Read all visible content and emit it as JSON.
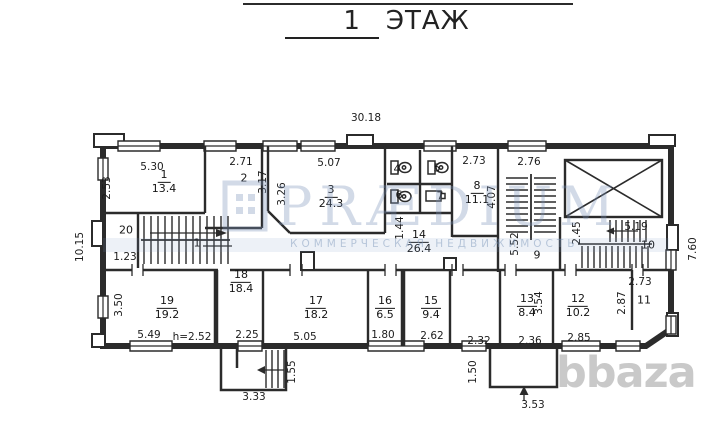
{
  "title": {
    "number": "1",
    "word": "ЭТАЖ"
  },
  "watermark_praedium": {
    "name": "PRÆDIUM",
    "tagline": "КОММЕРЧЕСКАЯ НЕДВИЖИМОСТЬ"
  },
  "watermark_bbaza": {
    "text": "bbaza"
  },
  "colors": {
    "line": "#2b2b2b",
    "label": "#1c1c1c",
    "watermark_blue": "#7a94b8",
    "watermark_gray": "#c9c9c9"
  },
  "rooms": [
    {
      "id": "room-1",
      "num": "1",
      "area": "13.4",
      "x": 164,
      "y": 182
    },
    {
      "id": "room-2",
      "num": "2",
      "x": 244,
      "y": 179
    },
    {
      "id": "room-3",
      "num": "3",
      "area": "24.3",
      "x": 331,
      "y": 197
    },
    {
      "id": "room-4",
      "num": "4",
      "x": 397,
      "y": 170
    },
    {
      "id": "room-5",
      "num": "5",
      "x": 437,
      "y": 169
    },
    {
      "id": "room-6",
      "num": "6",
      "x": 399,
      "y": 196
    },
    {
      "id": "room-7",
      "num": "7",
      "x": 440,
      "y": 197
    },
    {
      "id": "room-8",
      "num": "8",
      "area": "11.1",
      "x": 477,
      "y": 193
    },
    {
      "id": "room-9",
      "num": "9",
      "x": 537,
      "y": 256
    },
    {
      "id": "room-10",
      "num": "10",
      "x": 648,
      "y": 246
    },
    {
      "id": "room-11",
      "num": "11",
      "x": 644,
      "y": 301
    },
    {
      "id": "room-12",
      "num": "12",
      "area": "10.2",
      "x": 578,
      "y": 306
    },
    {
      "id": "room-13",
      "num": "13",
      "area": "8.4",
      "x": 527,
      "y": 306
    },
    {
      "id": "room-14",
      "num": "14",
      "area": "26.4",
      "x": 419,
      "y": 242
    },
    {
      "id": "room-15",
      "num": "15",
      "area": "9.4",
      "x": 431,
      "y": 308
    },
    {
      "id": "room-16",
      "num": "16",
      "area": "6.5",
      "x": 385,
      "y": 308
    },
    {
      "id": "room-17",
      "num": "17",
      "area": "18.2",
      "x": 316,
      "y": 308
    },
    {
      "id": "room-18",
      "num": "18",
      "area": "18.4",
      "x": 241,
      "y": 282
    },
    {
      "id": "room-19",
      "num": "19",
      "area": "19.2",
      "x": 167,
      "y": 308
    },
    {
      "id": "room-20",
      "num": "20",
      "x": 126,
      "y": 231
    },
    {
      "id": "landing-1",
      "num": "1",
      "x": 197,
      "y": 244
    }
  ],
  "dims": [
    {
      "id": "building-width",
      "text": "30.18",
      "x": 366,
      "y": 118
    },
    {
      "id": "building-height-left",
      "text": "10.15",
      "x": 80,
      "y": 247,
      "rot": true
    },
    {
      "id": "building-height-right",
      "text": "7.60",
      "x": 693,
      "y": 249,
      "rot": true
    },
    {
      "id": "dim-5-30",
      "text": "5.30",
      "x": 152,
      "y": 167
    },
    {
      "id": "dim-2-53",
      "text": "2.53",
      "x": 107,
      "y": 188,
      "rot": true
    },
    {
      "id": "dim-2-71",
      "text": "2.71",
      "x": 241,
      "y": 162
    },
    {
      "id": "dim-3-17",
      "text": "3.17",
      "x": 263,
      "y": 182,
      "rot": true
    },
    {
      "id": "dim-3-26",
      "text": "3.26",
      "x": 282,
      "y": 194,
      "rot": true
    },
    {
      "id": "dim-5-07",
      "text": "5.07",
      "x": 329,
      "y": 163
    },
    {
      "id": "dim-2-73-a",
      "text": "2.73",
      "x": 474,
      "y": 161
    },
    {
      "id": "dim-4-07",
      "text": "4.07",
      "x": 492,
      "y": 197,
      "rot": true
    },
    {
      "id": "dim-2-76",
      "text": "2.76",
      "x": 529,
      "y": 162
    },
    {
      "id": "dim-2-45",
      "text": "2.45",
      "x": 577,
      "y": 233,
      "rot": true
    },
    {
      "id": "dim-5-19",
      "text": "5.19",
      "x": 636,
      "y": 227
    },
    {
      "id": "dim-5-52",
      "text": "5.52",
      "x": 515,
      "y": 244,
      "rot": true
    },
    {
      "id": "dim-1-44",
      "text": "1.44",
      "x": 400,
      "y": 228,
      "rot": true
    },
    {
      "id": "dim-1-23",
      "text": "1.23",
      "x": 125,
      "y": 257
    },
    {
      "id": "dim-3-50",
      "text": "3.50",
      "x": 119,
      "y": 305,
      "rot": true
    },
    {
      "id": "dim-5-49",
      "text": "5.49",
      "x": 149,
      "y": 335
    },
    {
      "id": "dim-h-2-52",
      "text": "h=2.52",
      "x": 192,
      "y": 337
    },
    {
      "id": "dim-2-25",
      "text": "2.25",
      "x": 247,
      "y": 335
    },
    {
      "id": "dim-5-05",
      "text": "5.05",
      "x": 305,
      "y": 337
    },
    {
      "id": "dim-1-80",
      "text": "1.80",
      "x": 383,
      "y": 335
    },
    {
      "id": "dim-2-62",
      "text": "2.62",
      "x": 432,
      "y": 336
    },
    {
      "id": "dim-2-32",
      "text": "2.32",
      "x": 479,
      "y": 341
    },
    {
      "id": "dim-2-36",
      "text": "2.36",
      "x": 530,
      "y": 341
    },
    {
      "id": "dim-2-85",
      "text": "2.85",
      "x": 579,
      "y": 338
    },
    {
      "id": "dim-3-54",
      "text": "3.54",
      "x": 539,
      "y": 303,
      "rot": true
    },
    {
      "id": "dim-2-73-b",
      "text": "2.73",
      "x": 640,
      "y": 282
    },
    {
      "id": "dim-2-87",
      "text": "2.87",
      "x": 622,
      "y": 303,
      "rot": true
    },
    {
      "id": "dim-3-33",
      "text": "3.33",
      "x": 254,
      "y": 397
    },
    {
      "id": "dim-1-55",
      "text": "1.55",
      "x": 292,
      "y": 372,
      "rot": true
    },
    {
      "id": "dim-1-50",
      "text": "1.50",
      "x": 473,
      "y": 372,
      "rot": true
    },
    {
      "id": "dim-3-53",
      "text": "3.53",
      "x": 533,
      "y": 405
    }
  ]
}
